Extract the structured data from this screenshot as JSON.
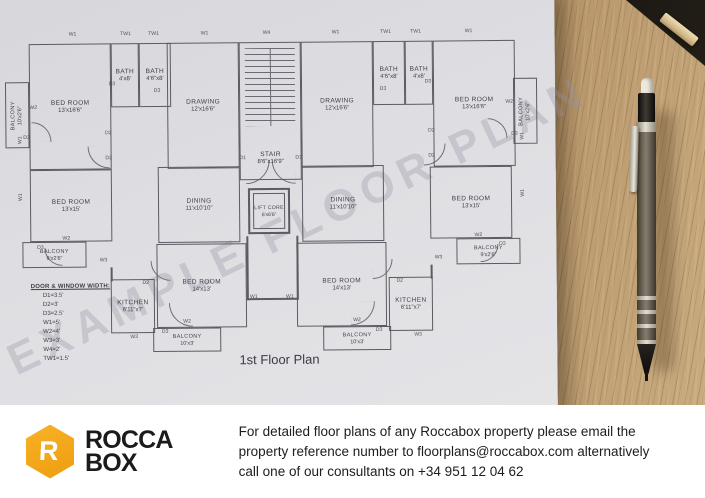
{
  "photo": {
    "watermark": "EXAMPLE FLOOR PLAN",
    "plan_title": "1st Floor Plan",
    "legend": {
      "title": "DOOR & WINDOW WIDTH:",
      "items": [
        "D1=3.5'",
        "D2=3'",
        "D3=2.5'",
        "W1=5'",
        "W2=4'",
        "W3=3'",
        "W4=2'",
        "TW1=1.5'"
      ]
    },
    "rooms": [
      {
        "name": "BED ROOM",
        "dims": "13'x16'6\"",
        "x": 30,
        "y": 42,
        "w": 82,
        "h": 126
      },
      {
        "name": "BATH",
        "dims": "4'x8'",
        "x": 112,
        "y": 42,
        "w": 28,
        "h": 64
      },
      {
        "name": "BATH",
        "dims": "4'6\"x8'",
        "x": 140,
        "y": 42,
        "w": 32,
        "h": 64
      },
      {
        "name": "DRAWING",
        "dims": "12'x16'6\"",
        "x": 168,
        "y": 42,
        "w": 72,
        "h": 126
      },
      {
        "name": "STAIR",
        "dims": "8'6\"x16'9\"",
        "x": 240,
        "y": 42,
        "w": 62,
        "h": 138,
        "cls": "stair"
      },
      {
        "name": "DRAWING",
        "dims": "12'x16'6\"",
        "x": 302,
        "y": 42,
        "w": 72,
        "h": 126
      },
      {
        "name": "BATH",
        "dims": "4'6\"x8'",
        "x": 374,
        "y": 42,
        "w": 32,
        "h": 64
      },
      {
        "name": "BATH",
        "dims": "4'x8'",
        "x": 406,
        "y": 42,
        "w": 28,
        "h": 64
      },
      {
        "name": "BED ROOM",
        "dims": "13'x16'6\"",
        "x": 434,
        "y": 42,
        "w": 82,
        "h": 126
      },
      {
        "name": "BALCONY",
        "dims": "10'x2'6\"",
        "x": 6,
        "y": 80,
        "w": 24,
        "h": 66,
        "cls": "vert balc"
      },
      {
        "name": "BALCONY",
        "dims": "10'x2'6\"",
        "x": 514,
        "y": 80,
        "w": 24,
        "h": 66,
        "cls": "vert balc"
      },
      {
        "name": "BED ROOM",
        "dims": "13'x15'",
        "x": 30,
        "y": 168,
        "w": 82,
        "h": 72
      },
      {
        "name": "DINING",
        "dims": "11'x10'10\"",
        "x": 158,
        "y": 166,
        "w": 82,
        "h": 76
      },
      {
        "name": "LIFT CORE",
        "dims": "6'x6'6\"",
        "x": 248,
        "y": 188,
        "w": 42,
        "h": 46,
        "cls": "lift"
      },
      {
        "name": "DINING",
        "dims": "11'x10'10\"",
        "x": 302,
        "y": 166,
        "w": 82,
        "h": 76
      },
      {
        "name": "BED ROOM",
        "dims": "13'x15'",
        "x": 430,
        "y": 168,
        "w": 82,
        "h": 72
      },
      {
        "name": "BALCONY",
        "dims": "9'x2'6\"",
        "x": 22,
        "y": 240,
        "w": 64,
        "h": 26,
        "cls": "balc"
      },
      {
        "name": "BALCONY",
        "dims": "9'x2'6\"",
        "x": 456,
        "y": 240,
        "w": 64,
        "h": 26,
        "cls": "balc"
      },
      {
        "name": "KITCHEN",
        "dims": "6'11\"x7'",
        "x": 110,
        "y": 278,
        "w": 44,
        "h": 54
      },
      {
        "name": "BED ROOM",
        "dims": "14'x13'",
        "x": 156,
        "y": 243,
        "w": 90,
        "h": 84
      },
      {
        "name": "BED ROOM",
        "dims": "14'x13'",
        "x": 296,
        "y": 243,
        "w": 90,
        "h": 84
      },
      {
        "name": "KITCHEN",
        "dims": "6'11\"x7'",
        "x": 388,
        "y": 278,
        "w": 44,
        "h": 54
      },
      {
        "name": "BALCONY",
        "dims": "10'x3'",
        "x": 152,
        "y": 327,
        "w": 68,
        "h": 24,
        "cls": "balc"
      },
      {
        "name": "BALCONY",
        "dims": "10'x3'",
        "x": 322,
        "y": 327,
        "w": 68,
        "h": 24,
        "cls": "balc"
      }
    ],
    "tags": [
      {
        "t": "W1",
        "x": 74,
        "y": 33
      },
      {
        "t": "TW1",
        "x": 127,
        "y": 33
      },
      {
        "t": "TW1",
        "x": 155,
        "y": 33
      },
      {
        "t": "W1",
        "x": 206,
        "y": 33
      },
      {
        "t": "W4",
        "x": 268,
        "y": 33
      },
      {
        "t": "W1",
        "x": 337,
        "y": 33
      },
      {
        "t": "TW1",
        "x": 387,
        "y": 33
      },
      {
        "t": "TW1",
        "x": 417,
        "y": 33
      },
      {
        "t": "W1",
        "x": 470,
        "y": 33
      },
      {
        "t": "W2",
        "x": 34,
        "y": 106
      },
      {
        "t": "W2",
        "x": 510,
        "y": 104
      },
      {
        "t": "D3",
        "x": 27,
        "y": 136
      },
      {
        "t": "D3",
        "x": 515,
        "y": 136
      },
      {
        "t": "D3",
        "x": 113,
        "y": 83
      },
      {
        "t": "D3",
        "x": 158,
        "y": 90
      },
      {
        "t": "D3",
        "x": 429,
        "y": 83
      },
      {
        "t": "D3",
        "x": 384,
        "y": 90
      },
      {
        "t": "D2",
        "x": 109,
        "y": 132
      },
      {
        "t": "D2",
        "x": 109,
        "y": 157
      },
      {
        "t": "D2",
        "x": 432,
        "y": 132
      },
      {
        "t": "D2",
        "x": 432,
        "y": 157
      },
      {
        "t": "D1",
        "x": 243,
        "y": 158
      },
      {
        "t": "D1",
        "x": 299,
        "y": 158
      },
      {
        "t": "W1",
        "x": 21,
        "y": 138,
        "v": 1
      },
      {
        "t": "W1",
        "x": 21,
        "y": 195,
        "v": 1
      },
      {
        "t": "W1",
        "x": 523,
        "y": 138,
        "v": 1
      },
      {
        "t": "W1",
        "x": 523,
        "y": 195,
        "v": 1
      },
      {
        "t": "W2",
        "x": 66,
        "y": 237
      },
      {
        "t": "W2",
        "x": 478,
        "y": 237
      },
      {
        "t": "D3",
        "x": 40,
        "y": 246
      },
      {
        "t": "D3",
        "x": 502,
        "y": 246
      },
      {
        "t": "W3",
        "x": 103,
        "y": 259
      },
      {
        "t": "W3",
        "x": 438,
        "y": 259
      },
      {
        "t": "D2",
        "x": 145,
        "y": 282
      },
      {
        "t": "D2",
        "x": 399,
        "y": 282
      },
      {
        "t": "W3",
        "x": 133,
        "y": 336
      },
      {
        "t": "W3",
        "x": 417,
        "y": 336
      },
      {
        "t": "W2",
        "x": 186,
        "y": 321
      },
      {
        "t": "W2",
        "x": 356,
        "y": 321
      },
      {
        "t": "D3",
        "x": 164,
        "y": 331
      },
      {
        "t": "D3",
        "x": 378,
        "y": 331
      },
      {
        "t": "W1",
        "x": 253,
        "y": 297
      },
      {
        "t": "W1",
        "x": 289,
        "y": 297
      }
    ]
  },
  "footer": {
    "logo": {
      "mark": "R",
      "line1": "ROCCA",
      "line2": "BOX",
      "accent_color": "#F2A51F"
    },
    "message_lines": [
      "For detailed floor plans of any Roccabox property please email the",
      "property reference number to floorplans@roccabox.com alternatively",
      "call one of our consultants on +34 951 12 04 62"
    ]
  }
}
